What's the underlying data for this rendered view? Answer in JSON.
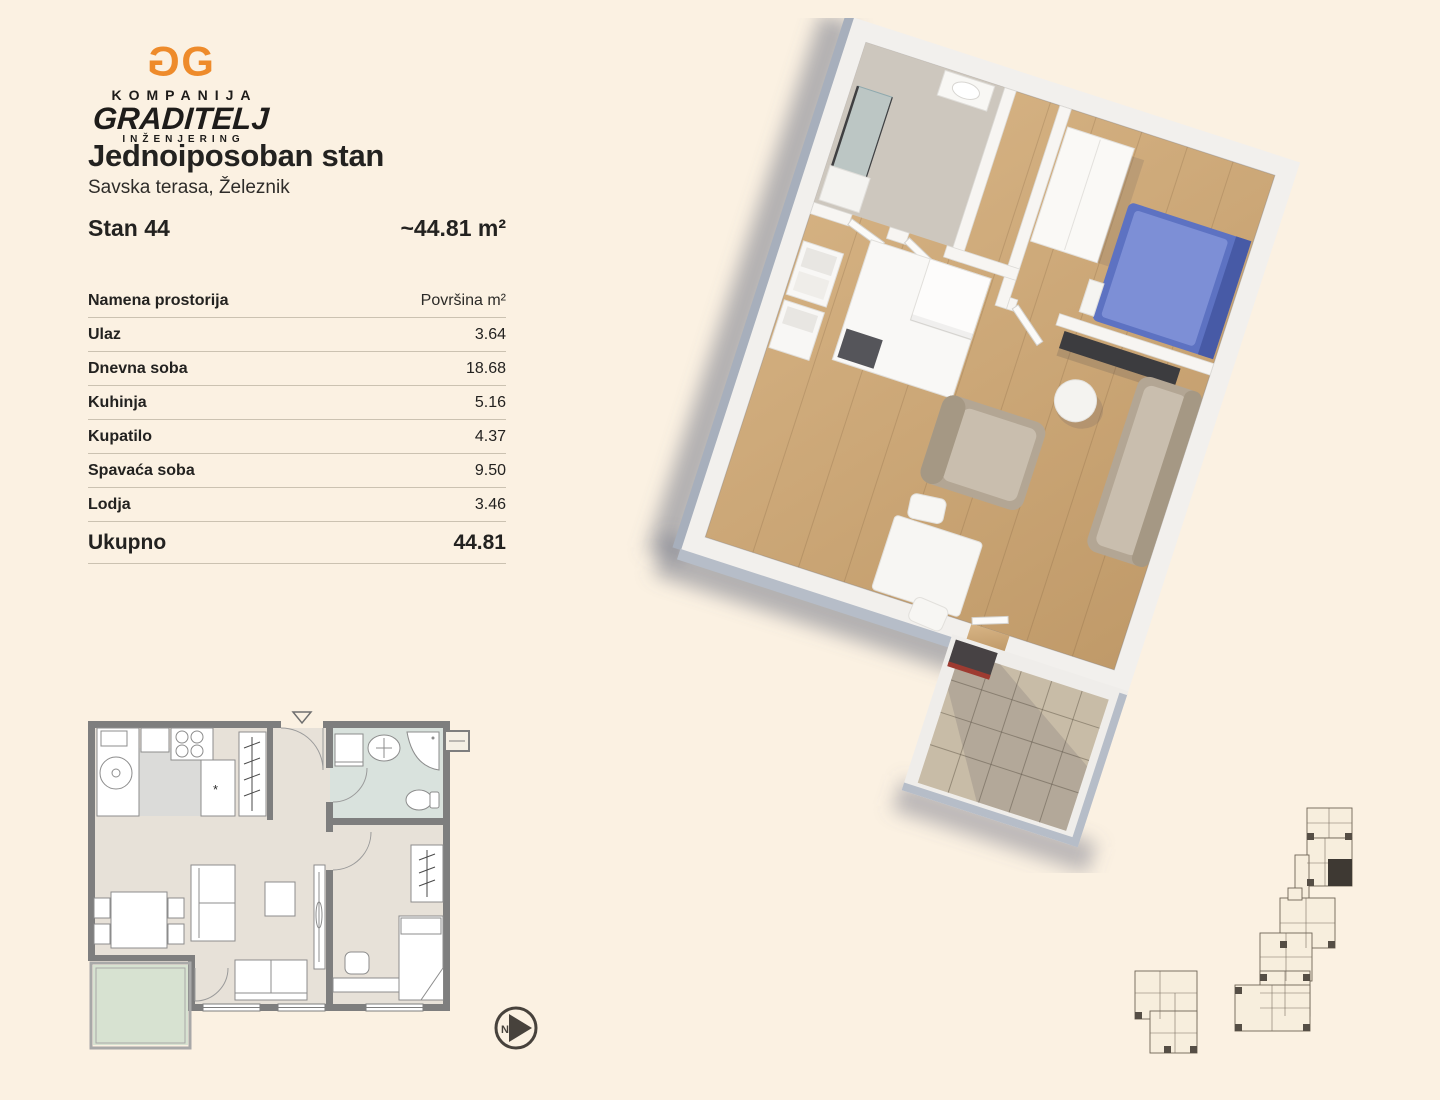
{
  "logo": {
    "monogram": "GG",
    "line1": "KOMPANIJA",
    "line2": "GRADITELJ",
    "line3": "INŽENJERING",
    "orange": "#EE8B2B"
  },
  "listing": {
    "title": "Jednoiposoban stan",
    "location": "Savska terasa, Železnik",
    "unit_label": "Stan 44",
    "area_label": "~44.81 m²"
  },
  "area_table": {
    "header": {
      "name": "Namena prostorija",
      "area": "Površina m²"
    },
    "rows": [
      {
        "name": "Ulaz",
        "area": "3.64"
      },
      {
        "name": "Dnevna soba",
        "area": "18.68"
      },
      {
        "name": "Kuhinja",
        "area": "5.16"
      },
      {
        "name": "Kupatilo",
        "area": "4.37"
      },
      {
        "name": "Spavaća soba",
        "area": "9.50"
      },
      {
        "name": "Lodja",
        "area": "3.46"
      }
    ],
    "total": {
      "name": "Ukupno",
      "area": "44.81"
    }
  },
  "compass": {
    "letter": "N"
  },
  "plan2d": {
    "dishwasher_mark": "*"
  },
  "colors": {
    "background": "#FBF1E2",
    "logo_orange": "#EE8B2B",
    "text": "#232220",
    "table_divider": "#CBC2B1",
    "plan_wall_gray": "#7E7E7E",
    "plan_floor_beige": "#E7E1D8",
    "plan_kitchen_floor": "#DBDBD9",
    "plan_bathroom_floor": "#D9E2DD",
    "plan_loggia_floor": "#D7E2D1",
    "render_wood_floor": "#CDA97C",
    "render_bed_blue": "#5D72C2",
    "render_sofa_taupe": "#B3A694",
    "render_tile": "#C8BCA7",
    "siteplan_highlight": "#3E3933"
  }
}
